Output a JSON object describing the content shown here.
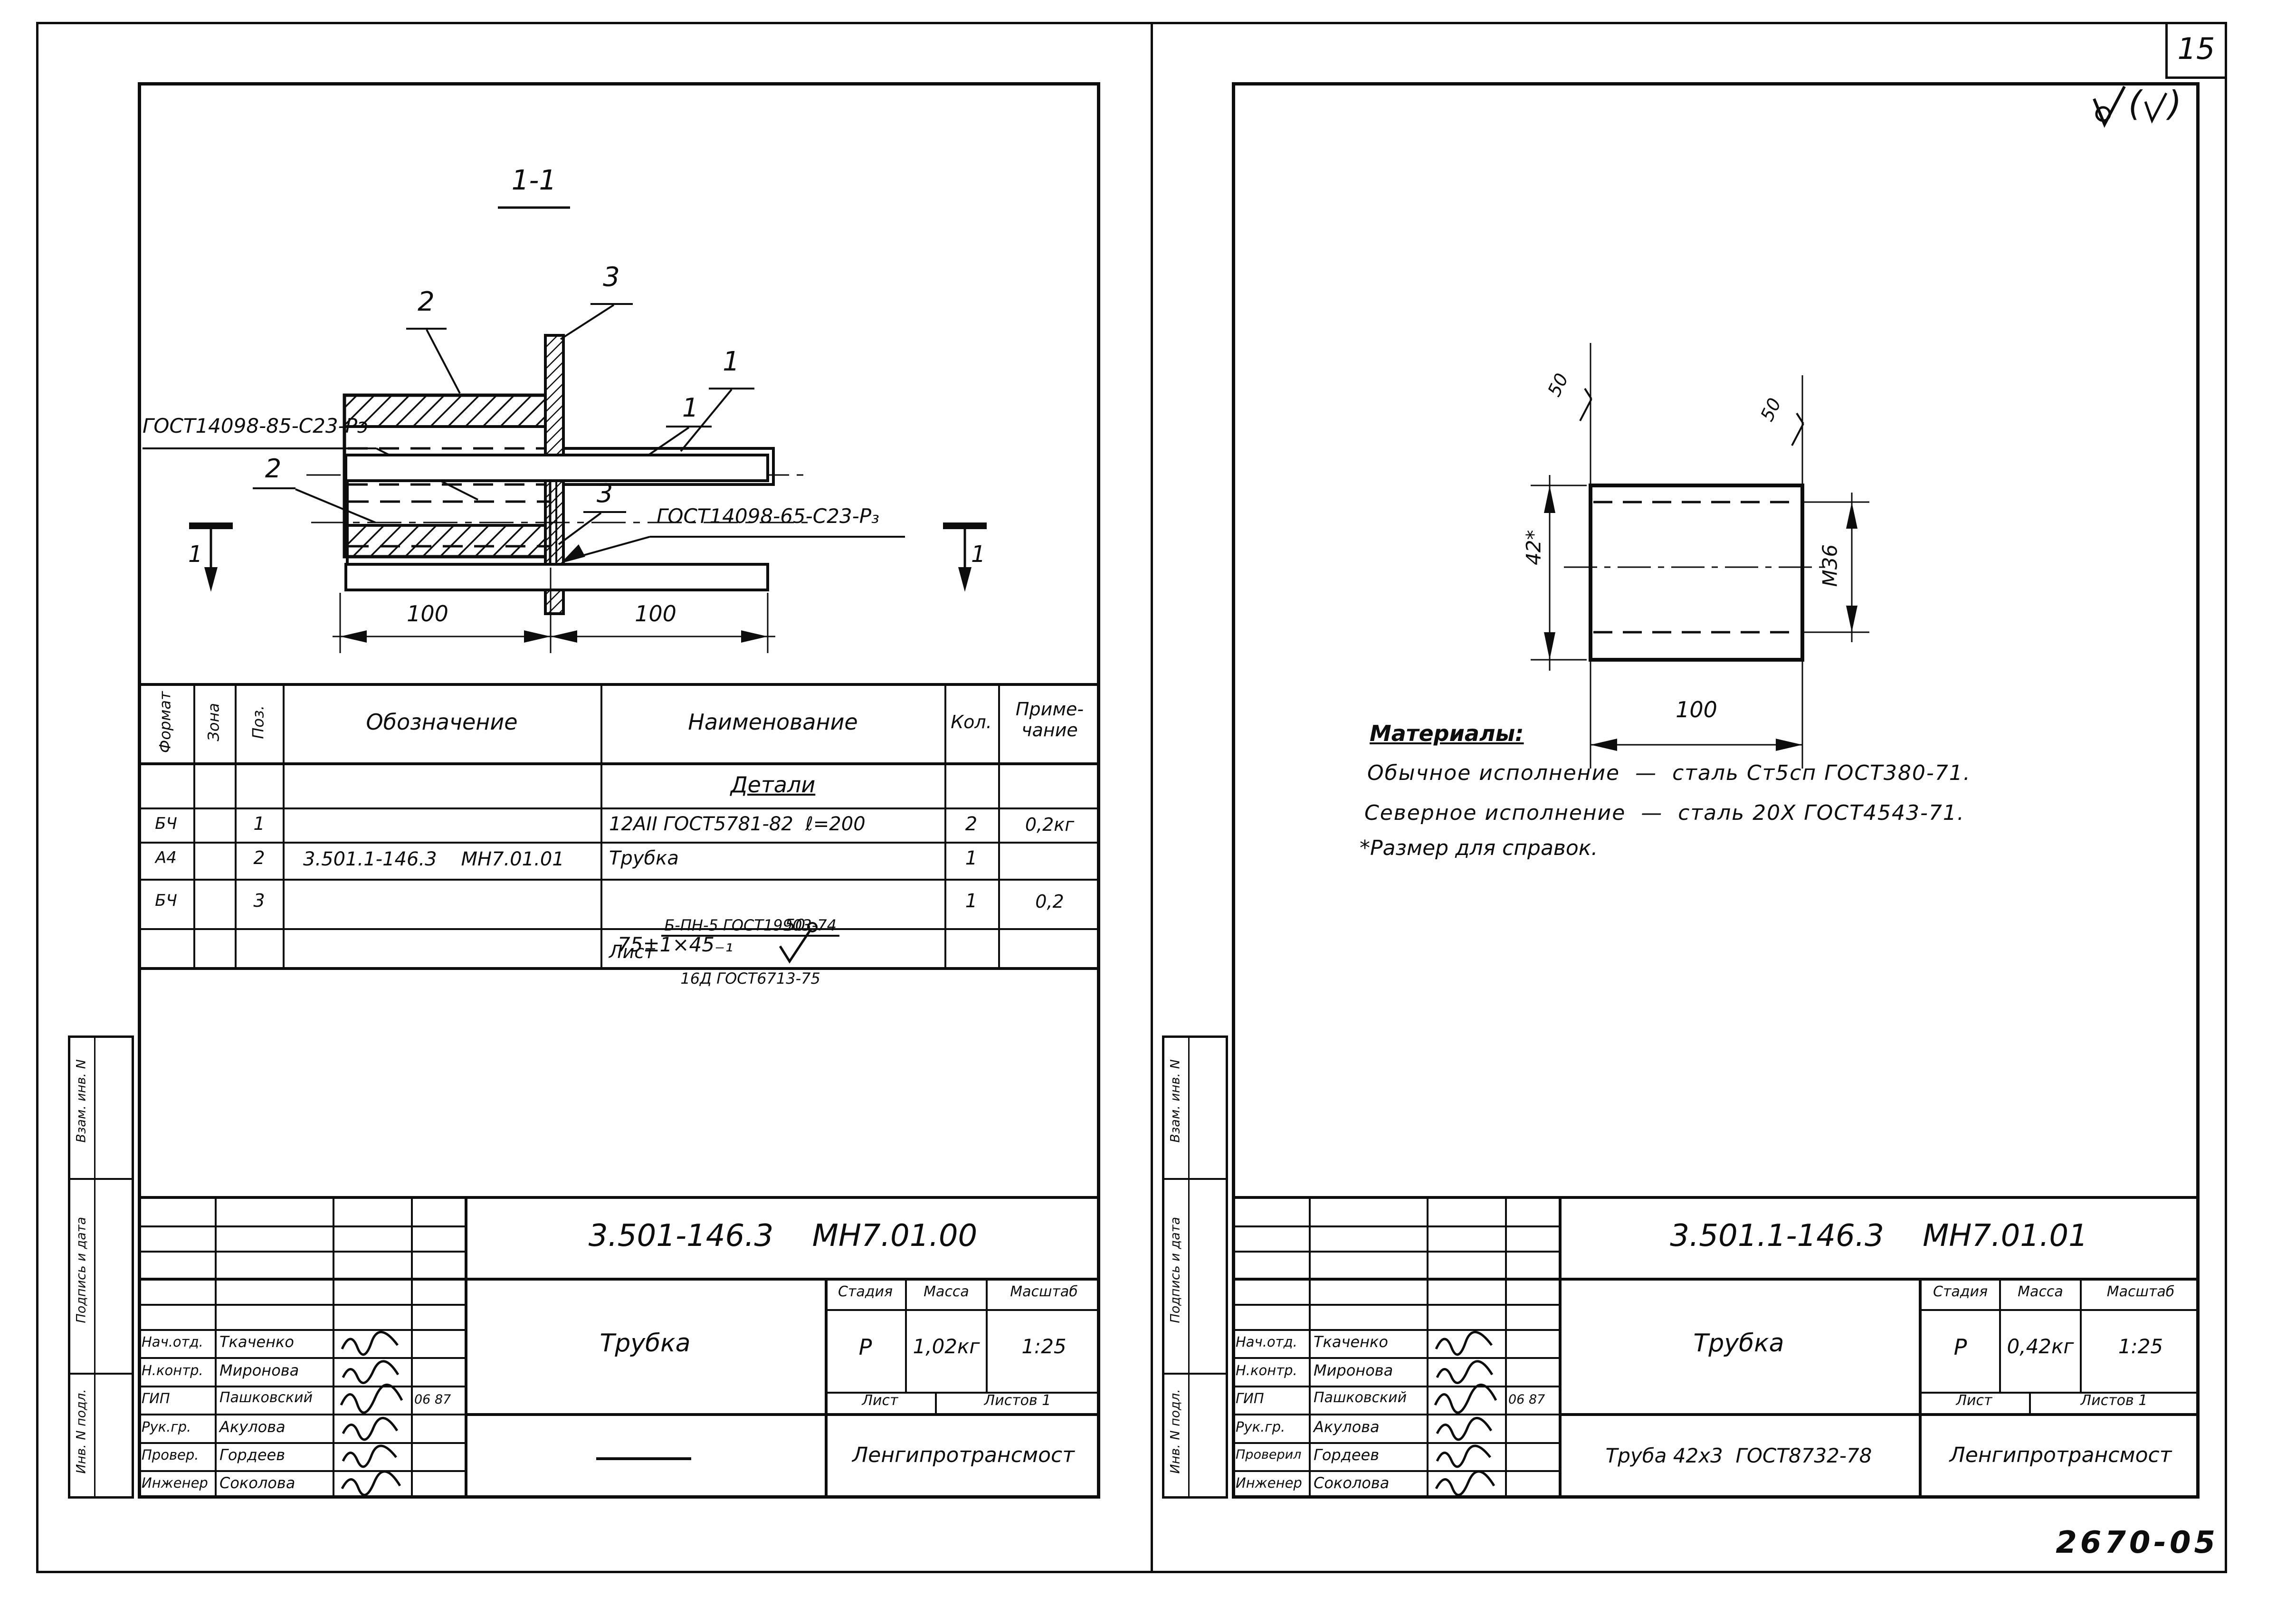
{
  "page": {
    "sheet_number": "15",
    "doc_code": "2670-05"
  },
  "strip": {
    "label1": "Взам. инв. N",
    "label2": "Подпись и дата",
    "label3": "Инв. N подл."
  },
  "left": {
    "section_title": "1-1",
    "v1": {
      "l1": "1",
      "l2": "2",
      "l3": "3"
    },
    "v2": {
      "l1": "1",
      "l2": "2",
      "l3": "3",
      "callout_top": "ГОСТ14098-85-С23-Рэ",
      "callout_bottom": "ГОСТ14098-65-С23-Р₃",
      "dim1": "100",
      "dim2": "100",
      "sec_left": "1",
      "sec_right": "1"
    },
    "spec": {
      "h_format": "Формат",
      "h_zone": "Зона",
      "h_pos": "Поз.",
      "h_designation": "Обозначение",
      "h_name": "Наименование",
      "h_qty": "Кол.",
      "h_note1": "Приме-",
      "h_note2": "чание",
      "group": "Детали",
      "r1": {
        "format": "БЧ",
        "pos": "1",
        "name": "12АII ГОСТ5781-82  ℓ=200",
        "qty": "2",
        "note": "0,2кг"
      },
      "r2": {
        "format": "А4",
        "pos": "2",
        "designation": "3.501.1-146.3    МН7.01.01",
        "name": "Трубка",
        "qty": "1"
      },
      "r3": {
        "format": "БЧ",
        "pos": "3",
        "name_word": "Лист",
        "fr_top": "Б-ПН-5 ГОСТ19903-74",
        "fr_bottom": "16Д ГОСТ6713-75",
        "qty": "1",
        "note": "0,2"
      },
      "r4": {
        "text": "75±1×45₋₁",
        "flag": "50"
      }
    },
    "tb": {
      "doc_number": "3.501-146.3    МН7.01.00",
      "title": "Трубка",
      "stage_label": "Стадия",
      "mass_label": "Масса",
      "scale_label": "Масштаб",
      "stage": "Р",
      "mass": "1,02кг",
      "scale": "1:25",
      "sheet_label": "Лист",
      "sheets_label": "Листов 1",
      "org": "Ленгипротрансмост",
      "roles": [
        "Нач.отд.",
        "Н.контр.",
        "ГИП",
        "Рук.гр.",
        "Провер.",
        "Инженер"
      ],
      "names": [
        "Ткаченко",
        "Миронова",
        "Пашковский",
        "Акулова",
        "Гордеев",
        "Соколова"
      ],
      "gip_date": "06 87"
    }
  },
  "right": {
    "dims": {
      "width": "100",
      "height": "42*",
      "thread": "М36",
      "rough_left": "50",
      "rough_right": "50"
    },
    "materials": {
      "heading": "Материалы:",
      "line1": "Обычное исполнение  —  сталь Ст5сп ГОСТ380-71.",
      "line2": "Северное исполнение  —  сталь 20Х ГОСТ4543-71.",
      "footnote": "*Размер для справок."
    },
    "tb": {
      "doc_number": "3.501.1-146.3    МН7.01.01",
      "title": "Трубка",
      "material": "Труба 42х3  ГОСТ8732-78",
      "stage_label": "Стадия",
      "mass_label": "Масса",
      "scale_label": "Масштаб",
      "stage": "Р",
      "mass": "0,42кг",
      "scale": "1:25",
      "sheet_label": "Лист",
      "sheets_label": "Листов 1",
      "org": "Ленгипротрансмост",
      "roles": [
        "Нач.отд.",
        "Н.контр.",
        "ГИП",
        "Рук.гр.",
        "Проверил",
        "Инженер"
      ],
      "names": [
        "Ткаченко",
        "Миронова",
        "Пашковский",
        "Акулова",
        "Гордеев",
        "Соколова"
      ],
      "gip_date": "06 87"
    }
  }
}
